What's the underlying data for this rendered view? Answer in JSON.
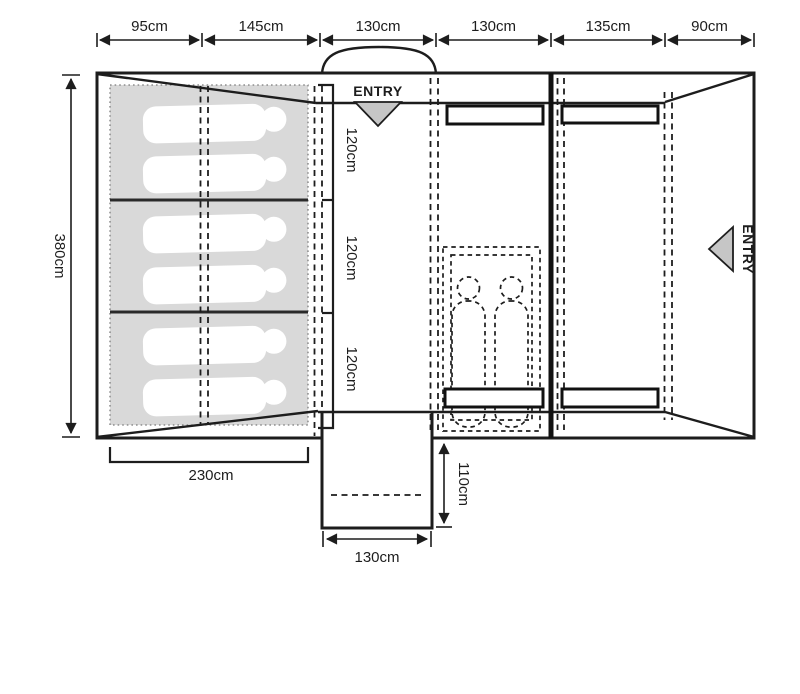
{
  "plan": {
    "entries": {
      "top": "ENTRY",
      "right": "ENTRY"
    },
    "dimensions": {
      "top_widths": [
        "95cm",
        "145cm",
        "130cm",
        "130cm",
        "135cm",
        "90cm"
      ],
      "overall_depth": "380cm",
      "bedroom_width": "230cm",
      "living_section_depths": [
        "120cm",
        "120cm",
        "120cm"
      ],
      "porch_depth": "110cm",
      "porch_width": "130cm"
    },
    "counts": {
      "bedroom_sleepers": 6,
      "inner_tent_sleepers": 2,
      "windows": 4
    },
    "colors": {
      "line": "#1d1d1d",
      "bedroom_fill": "#d9d9d9",
      "sleeper_fill": "#ffffff",
      "entry_arrow_fill": "#c6c6c6",
      "background": "#ffffff"
    }
  }
}
